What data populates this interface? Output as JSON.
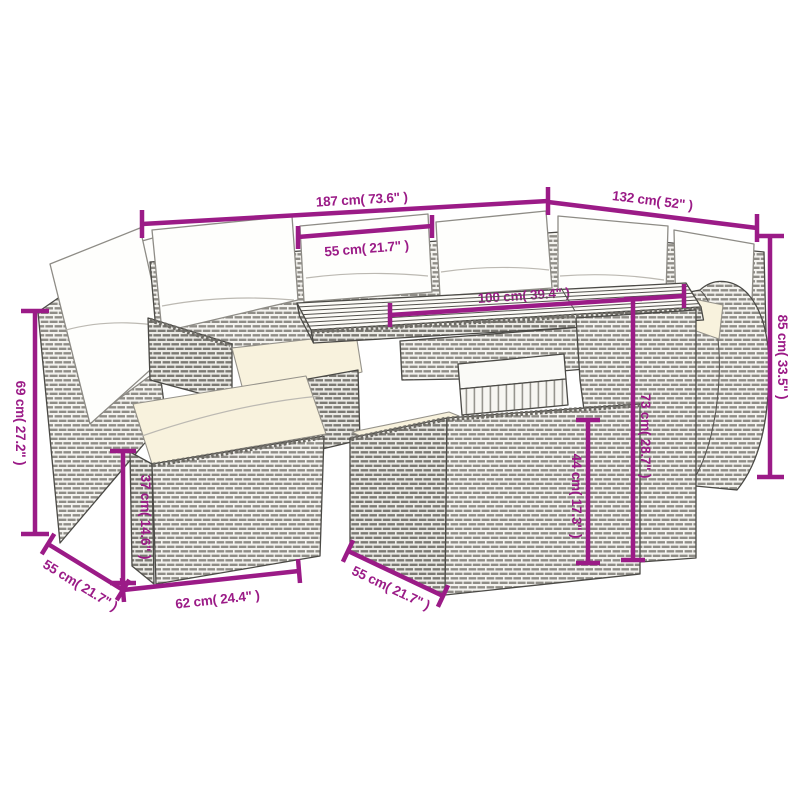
{
  "meta": {
    "figure": "rattan garden furniture set line drawing with dimension annotations",
    "pieces": [
      "corner chair with tall backrest",
      "sofa with back pillows",
      "ottoman",
      "dining table with slatted wood top",
      "bench",
      "curved-arm sofa"
    ],
    "accent_color": "#9B1B87",
    "cushion_color": "#f8f2dd",
    "linework_color": "#4b4a46",
    "background_color": "#ffffff",
    "units": [
      "cm",
      "inches"
    ]
  },
  "dimensions": [
    {
      "id": "sofa-width-long-side",
      "cm": 187,
      "inch": 73.6,
      "label": "187 cm( 73.6\" )"
    },
    {
      "id": "sofa-width-short-side",
      "cm": 132,
      "inch": 52,
      "label": "132 cm( 52\" )"
    },
    {
      "id": "seat-cushion-width",
      "cm": 55,
      "inch": 21.7,
      "label": "55 cm( 21.7\" )"
    },
    {
      "id": "table-length",
      "cm": 100,
      "inch": 39.4,
      "label": "100 cm( 39.4\" )"
    },
    {
      "id": "overall-height",
      "cm": 85,
      "inch": 33.5,
      "label": "85 cm( 33.5\" )"
    },
    {
      "id": "left-backrest-height",
      "cm": 69,
      "inch": 27.2,
      "label": "69 cm( 27.2\" )"
    },
    {
      "id": "ottoman-height",
      "cm": 37,
      "inch": 14.6,
      "label": "37 cm( 14.6\" )"
    },
    {
      "id": "ottoman-depth",
      "cm": 55,
      "inch": 21.7,
      "label": "55 cm( 21.7\" )"
    },
    {
      "id": "ottoman-width",
      "cm": 62,
      "inch": 24.4,
      "label": "62 cm( 24.4\" )"
    },
    {
      "id": "bench-depth",
      "cm": 55,
      "inch": 21.7,
      "label": "55 cm( 21.7\" )"
    },
    {
      "id": "table-height",
      "cm": 73,
      "inch": 28.7,
      "label": "73 cm( 28.7\" )"
    },
    {
      "id": "bench-height",
      "cm": 44,
      "inch": 17.3,
      "label": "44 cm( 17.3\" )"
    }
  ]
}
